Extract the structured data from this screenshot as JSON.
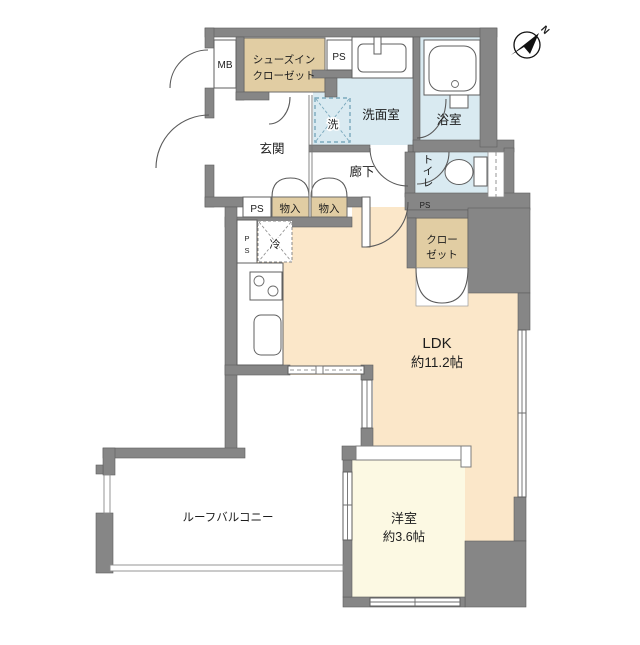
{
  "colors": {
    "wall": "#868686",
    "tan": "#e1cda3",
    "water": "#d9eaf1",
    "ldk": "#fbe7c9",
    "western": "#fcf9e3"
  },
  "compass": {
    "north": "N"
  },
  "labels": {
    "mb": "MB",
    "ps": "PS",
    "ps_p": "P",
    "ps_s": "S",
    "shoes_closet_line1": "シューズイン",
    "shoes_closet_line2": "クローゼット",
    "washroom": "洗面室",
    "washer": "洗",
    "bath": "浴室",
    "toilet": "トイレ",
    "entrance": "玄関",
    "hallway": "廊下",
    "storage": "物入",
    "fridge": "冷",
    "closet_line1": "クロー",
    "closet_line2": "ゼット",
    "ldk": "LDK",
    "ldk_size": "約11.2帖",
    "western_room": "洋室",
    "western_size": "約3.6帖",
    "roof_balcony": "ルーフバルコニー"
  }
}
